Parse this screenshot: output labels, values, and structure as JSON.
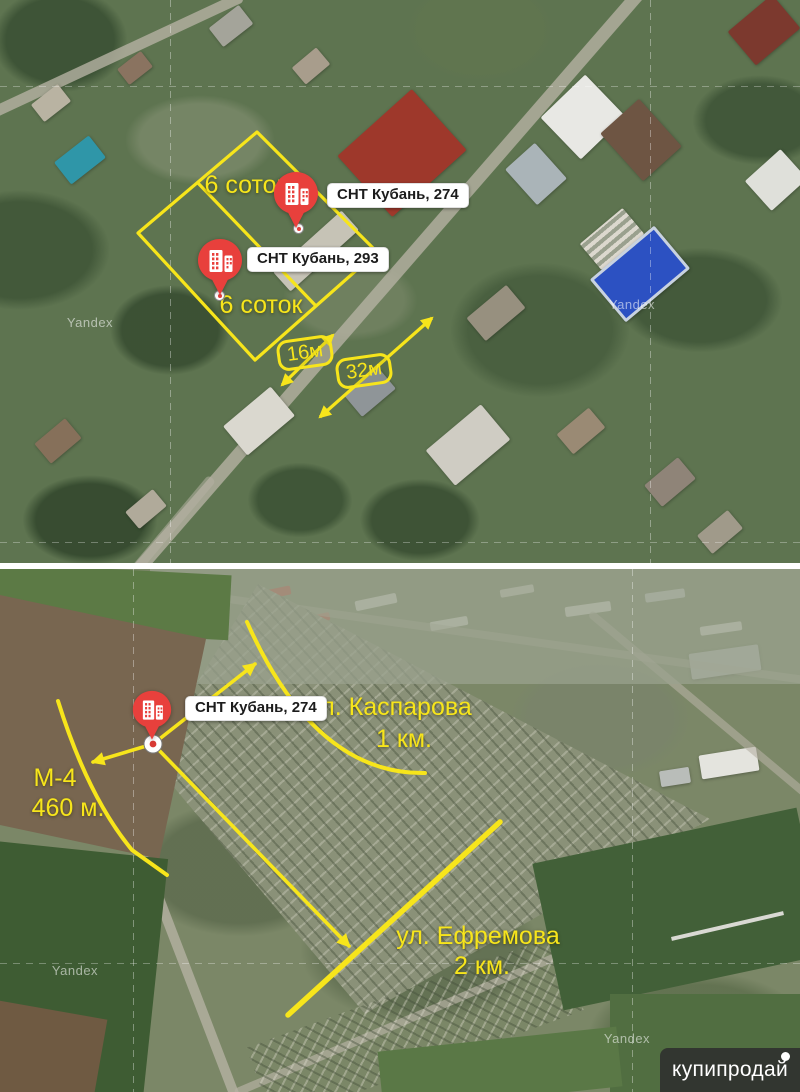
{
  "colors": {
    "annotation_yellow": "#F7E51B",
    "pin_red": "#E8403C",
    "label_bg": "#FFFFFF",
    "label_text": "#1C1C1C",
    "badge_bg": "#2D2D2D",
    "badge_text": "#FFFFFF"
  },
  "top_map": {
    "area_labels": [
      "6 соток",
      "6 соток"
    ],
    "pins": [
      {
        "label": "СНТ Кубань, 274"
      },
      {
        "label": "СНТ Кубань, 293"
      }
    ],
    "measurements": {
      "width_short": "16м",
      "width_long": "32м"
    },
    "watermark": "Yandex"
  },
  "bottom_map": {
    "pin": {
      "label": "СНТ Кубань, 274"
    },
    "annotations": {
      "kasparova": {
        "street": "ул. Каспарова",
        "distance": "1 км."
      },
      "m4": {
        "street": "М-4",
        "distance": "460 м."
      },
      "efremova": {
        "street": "ул. Ефремова",
        "distance": "2 км."
      }
    },
    "watermark": "Yandex"
  },
  "brand": {
    "text": "купипродай"
  }
}
